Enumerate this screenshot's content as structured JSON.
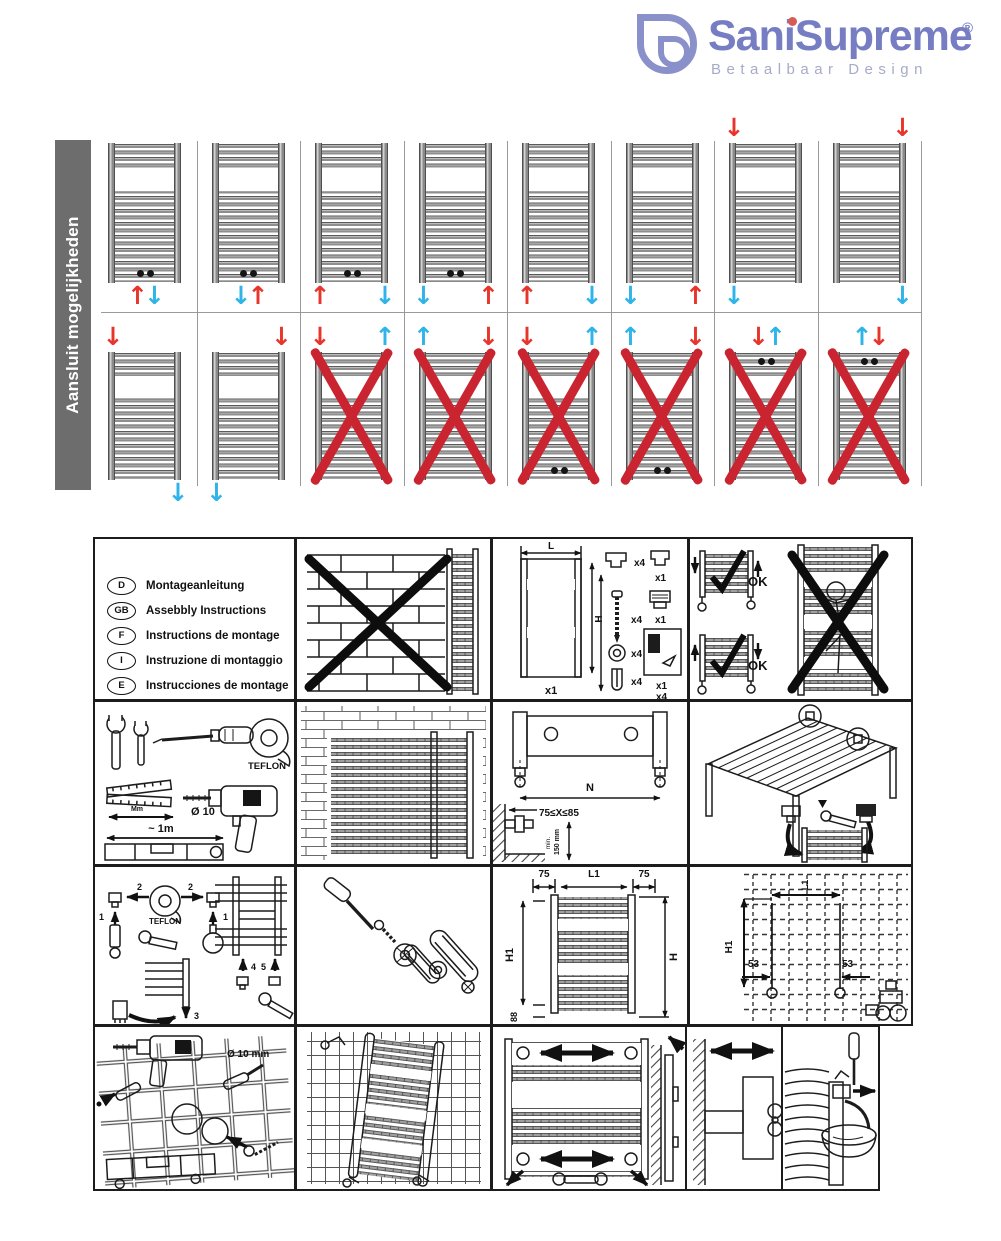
{
  "header": {
    "brand": "SaniSupreme",
    "reg": "®",
    "tagline": "Betaalbaar Design"
  },
  "colors": {
    "brand_purple": "#767dc3",
    "red_arrow": "#e8352b",
    "blue_arrow": "#2fb4e9",
    "cross_red": "#c92430",
    "sidebar_gray": "#6d6d6d"
  },
  "connection_grid": {
    "side_label": "Aansluit mogelijkheden",
    "rows": [
      {
        "cells": [
          {
            "dots": "bottom",
            "cross": false,
            "arrows": [
              {
                "pos": "bc-left",
                "color": "red",
                "dir": "up"
              },
              {
                "pos": "bc-right",
                "color": "blue",
                "dir": "down"
              }
            ]
          },
          {
            "dots": "bottom",
            "cross": false,
            "arrows": [
              {
                "pos": "bc-left",
                "color": "blue",
                "dir": "down"
              },
              {
                "pos": "bc-right",
                "color": "red",
                "dir": "up"
              }
            ]
          },
          {
            "dots": "bottom",
            "cross": false,
            "arrows": [
              {
                "pos": "bl",
                "color": "red",
                "dir": "up"
              },
              {
                "pos": "br",
                "color": "blue",
                "dir": "down"
              }
            ]
          },
          {
            "dots": "bottom",
            "cross": false,
            "arrows": [
              {
                "pos": "bl",
                "color": "blue",
                "dir": "down"
              },
              {
                "pos": "br",
                "color": "red",
                "dir": "up"
              }
            ]
          },
          {
            "dots": "none",
            "cross": false,
            "arrows": [
              {
                "pos": "bl",
                "color": "red",
                "dir": "up"
              },
              {
                "pos": "br",
                "color": "blue",
                "dir": "down"
              }
            ]
          },
          {
            "dots": "none",
            "cross": false,
            "arrows": [
              {
                "pos": "bl",
                "color": "blue",
                "dir": "down"
              },
              {
                "pos": "br",
                "color": "red",
                "dir": "up"
              }
            ]
          },
          {
            "dots": "none",
            "cross": false,
            "arrows": [
              {
                "pos": "tl",
                "color": "red",
                "dir": "down"
              },
              {
                "pos": "bl",
                "color": "blue",
                "dir": "down"
              }
            ]
          },
          {
            "dots": "none",
            "cross": false,
            "arrows": [
              {
                "pos": "tr",
                "color": "red",
                "dir": "down"
              },
              {
                "pos": "br",
                "color": "blue",
                "dir": "down"
              }
            ]
          }
        ]
      },
      {
        "cells": [
          {
            "dots": "none",
            "cross": false,
            "arrows": [
              {
                "pos": "tl",
                "color": "red",
                "dir": "down"
              },
              {
                "pos": "br",
                "color": "blue",
                "dir": "down"
              }
            ]
          },
          {
            "dots": "none",
            "cross": false,
            "arrows": [
              {
                "pos": "tr",
                "color": "red",
                "dir": "down"
              },
              {
                "pos": "bl",
                "color": "blue",
                "dir": "down"
              }
            ]
          },
          {
            "dots": "none",
            "cross": true,
            "arrows": [
              {
                "pos": "tl",
                "color": "red",
                "dir": "down"
              },
              {
                "pos": "tr",
                "color": "blue",
                "dir": "up"
              }
            ]
          },
          {
            "dots": "none",
            "cross": true,
            "arrows": [
              {
                "pos": "tl",
                "color": "blue",
                "dir": "up"
              },
              {
                "pos": "tr",
                "color": "red",
                "dir": "down"
              }
            ]
          },
          {
            "dots": "bottom",
            "cross": true,
            "arrows": [
              {
                "pos": "tl",
                "color": "red",
                "dir": "down"
              },
              {
                "pos": "tr",
                "color": "blue",
                "dir": "up"
              }
            ]
          },
          {
            "dots": "bottom",
            "cross": true,
            "arrows": [
              {
                "pos": "tl",
                "color": "blue",
                "dir": "up"
              },
              {
                "pos": "tr",
                "color": "red",
                "dir": "down"
              }
            ]
          },
          {
            "dots": "top",
            "cross": true,
            "arrows": [
              {
                "pos": "tc-left",
                "color": "red",
                "dir": "down"
              },
              {
                "pos": "tc-right",
                "color": "blue",
                "dir": "up"
              }
            ]
          },
          {
            "dots": "top",
            "cross": true,
            "arrows": [
              {
                "pos": "tc-left",
                "color": "blue",
                "dir": "up"
              },
              {
                "pos": "tc-right",
                "color": "red",
                "dir": "down"
              }
            ]
          }
        ]
      }
    ]
  },
  "panels": {
    "languages": {
      "items": [
        {
          "code": "D",
          "text": "Montageanleitung"
        },
        {
          "code": "GB",
          "text": "Assebbly Instructions"
        },
        {
          "code": "F",
          "text": "Instructions de montage"
        },
        {
          "code": "I",
          "text": "Instruzione di montaggio"
        },
        {
          "code": "E",
          "text": "Instrucciones de montage"
        },
        {
          "code": "H",
          "text": "Szerelesi utasitas"
        },
        {
          "code": "NL",
          "text": "Montageaanwijzing"
        }
      ]
    },
    "parts": {
      "length_label": "L",
      "height_label": "H",
      "radiator_qty": "x1",
      "bracket_qty": "x4",
      "screw_qty": "x4",
      "washer_qty": "x4",
      "anchor_qty": "x4",
      "cap_qty": "x1",
      "vent_qty": "x1",
      "manual_qty": "x1",
      "manual_qty2": "x4"
    },
    "orientation": {
      "ok1": "OK",
      "ok2": "OK"
    },
    "tools": {
      "teflon_label": "TEFLON",
      "ruler_label": "Mm",
      "drill_label": "Ø 10",
      "level_label": "~ 1m"
    },
    "valve_distance": {
      "n_label": "N",
      "x_range": "75≤X≤85",
      "min_label": "min.",
      "height_label": "150 mm"
    },
    "teflon_steps": {
      "teflon_label": "TEFLON",
      "step1a": "1",
      "step1b": "1",
      "step2a": "2",
      "step2b": "2",
      "step3": "3",
      "step4": "4",
      "step5": "5"
    },
    "dimensions": {
      "left_margin": "75",
      "center": "L1",
      "right_margin": "75",
      "h1": "H1",
      "h": "H",
      "bottom": "88"
    },
    "drill_template": {
      "l1": "L1",
      "h1": "H1",
      "left_53": "53",
      "right_53": "53"
    },
    "drilling": {
      "dia_label": "Ø 10 mm"
    }
  }
}
